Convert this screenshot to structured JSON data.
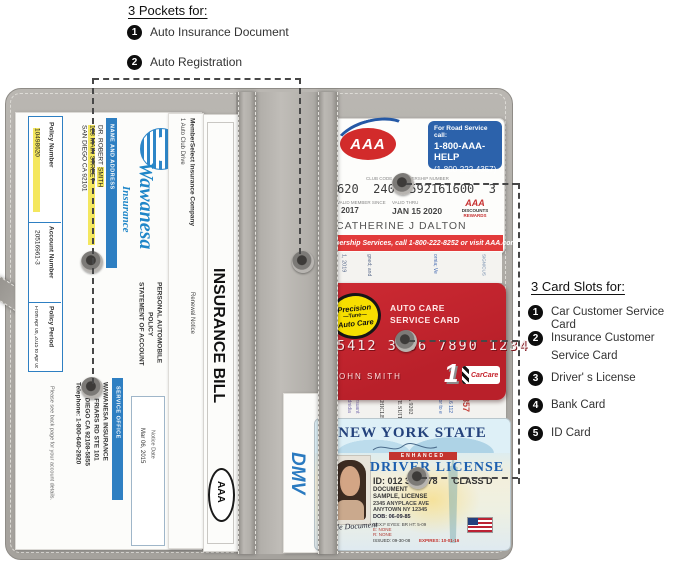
{
  "annotations": {
    "pockets": {
      "title": "3 Pockets for:",
      "items": [
        {
          "num": "1",
          "label": "Auto Insurance Document"
        },
        {
          "num": "2",
          "label": "Auto Registration"
        }
      ]
    },
    "card_slots": {
      "title": "3 Card Slots for:",
      "items": [
        {
          "num": "1",
          "label": "Car Customer Service Card"
        },
        {
          "num": "2",
          "label": "Insurance Customer",
          "label2": "Service Card"
        },
        {
          "num": "3",
          "label": "Driver' s License"
        },
        {
          "num": "4",
          "label": "Bank Card"
        },
        {
          "num": "5",
          "label": "ID Card"
        }
      ]
    }
  },
  "colors": {
    "wallet_gray": "#aeaba6",
    "wawanesa_blue": "#1f86c8",
    "aaa_red": "#d22b2b",
    "aaa_blue": "#2c62ab",
    "banner_red": "#e23b3b",
    "card_red": "#c5232d",
    "logo_yellow": "#f7df00",
    "license_blue": "#1d5fae",
    "enhanced_red": "#c3342f",
    "highlight_yellow": "#f4e75e"
  },
  "insurance_statement": {
    "brand": "Wawanesa",
    "brand_sub": "Insurance",
    "table": {
      "policy_number_label": "Policy Number",
      "policy_number": "10498620",
      "account_number_label": "Account Number",
      "account_number": "20516961-3",
      "policy_period_label": "Policy Period",
      "policy_period": "From Apr 08, 2015 to Apr 08, 2016"
    },
    "name_address_label": "NAME AND ADDRESS",
    "name_prefix": "DR. ROBERT ",
    "name_highlight": "SMITH",
    "street": "123 MAIN STREET",
    "city": "SAN DIEGO CA 92101",
    "doc_title_line1": "PERSONAL AUTOMOBILE",
    "doc_title_line2": "POLICY",
    "doc_title_line3": "STATEMENT OF ACCOUNT",
    "service_office_label": "SERVICE OFFICE",
    "service_office_line1": "WAWANESA INSURANCE",
    "service_office_line2": "9050 FRIARS RD STE 101",
    "service_office_line3": "SAN DIEGO CA 92108-5855",
    "service_office_line4": "Telephone: 1-800-640-2920",
    "notice_date_label": "Notice Date",
    "notice_date": "Mar 06, 2015",
    "footer": "Please see back page for your account details."
  },
  "member_select": {
    "line1": "MemberSelect Insurance Company",
    "line2": "1 Auto Club Drive",
    "renewal": "Renewal Notice"
  },
  "insurance_bill": {
    "title": "INSURANCE BILL",
    "logo": "AAA"
  },
  "aaa_card": {
    "logo": "AAA",
    "road_service_line1": "For Road Service call:",
    "road_service_line2": "1-800-AAA-HELP",
    "road_service_line3": "(1-800-222-4357)",
    "club_code_label": "CLUB CODE",
    "membership_number_label": "MEMBERSHIP NUMBER",
    "number": "620  240  592161600  3",
    "member_since_label": "VALID MEMBER SINCE",
    "member_since": "2017",
    "valid_thru_label": "VALID THRU",
    "valid_thru": "JAN 15 2020",
    "holder": "CATHERINE J DALTON",
    "rewards_brand": "AAA",
    "rewards_line1": "DISCOUNTS",
    "rewards_line2": "REWARDS",
    "banner": "Membership Services, call 1-800-222-8252 or visit AAA.com"
  },
  "registration_strip": {
    "frag1": "1, 2019",
    "frag2": "gned; and",
    "frag3": "ornia; Ve",
    "frag4": "SIGN/CUS"
  },
  "auto_care_card": {
    "logo_line1": "Precision",
    "logo_line2": "—Tune—",
    "logo_line3": "Auto Care",
    "title_line1": "AUTO CARE",
    "title_line2": "SERVICE CARD",
    "number": "5412 3456 7890 1234",
    "holder": "JOHN SMITH",
    "badge_num": "1",
    "badge": "CarCare"
  },
  "reg_top_strip": {
    "frag1": "nodnidia",
    "frag2": "pursuant",
    "frag3": "VEHICLE",
    "frag4": "AVE SUIT",
    "frag5": "CA 9202",
    "frag6": "prior to e",
    "frag7": "05.6 112",
    "red_number": "8857"
  },
  "dmv_doc": {
    "logo": "DMV"
  },
  "license": {
    "state": "NEW YORK STATE",
    "enhanced": "ENHANCED",
    "title": "DRIVER LICENSE",
    "id_line": "ID: 012 345 678",
    "class_label": "CLASS D",
    "name_line1": "DOCUMENT",
    "name_line2": "SAMPLE, LICENSE",
    "address_line1": "2345 ANYPLACE AVE",
    "address_line2": "ANYTOWN NY 12345",
    "dob": "DOB: 06-09-85",
    "sex_line": "SEX:F  EYES: BR  HT: 5-09",
    "e_line": "E: NONE",
    "r_line": "R: NONE",
    "issued": "ISSUED: 09-30-08",
    "expires": "EXPIRES: 10-01-16",
    "signature": "Sample Document"
  }
}
